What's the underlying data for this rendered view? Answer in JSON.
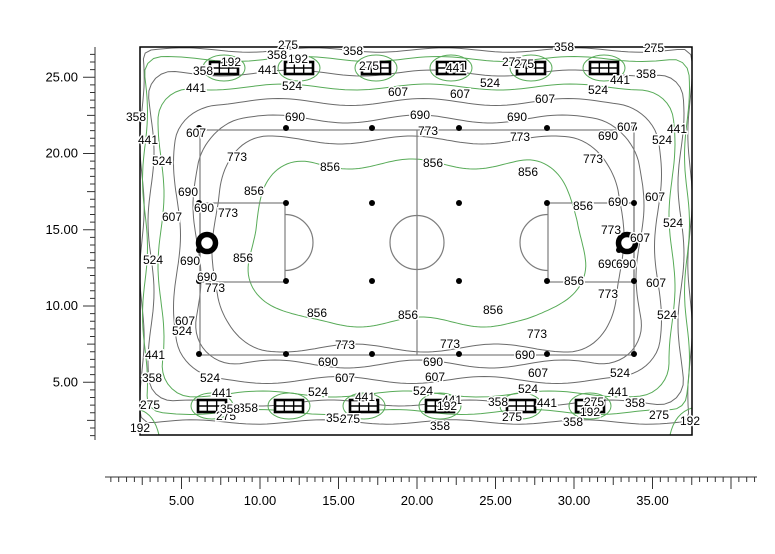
{
  "chart_data": {
    "type": "contour",
    "title": "Isolux contour plot of sports field illuminance (lux)",
    "legend_position": "none",
    "grid": false,
    "x_axis": {
      "tick_labels": [
        "5.00",
        "10.00",
        "15.00",
        "20.00",
        "25.00",
        "30.00",
        "35.00"
      ],
      "tick_values": [
        5,
        10,
        15,
        20,
        25,
        30,
        35
      ],
      "minor_step": 0.5,
      "medium_step": 2.5,
      "range": [
        0.5,
        41.5
      ],
      "px": {
        "origin": 103,
        "per_unit": 15.7,
        "line_y": 477,
        "line_x0": 105,
        "line_x1": 757
      }
    },
    "y_axis": {
      "tick_labels": [
        "5.00",
        "10.00",
        "15.00",
        "20.00",
        "25.00"
      ],
      "tick_values": [
        5,
        10,
        15,
        20,
        25
      ],
      "minor_step": 0.5,
      "medium_step": 2.5,
      "range": [
        1.5,
        26.5
      ],
      "px": {
        "origin": 458.5,
        "per_unit": 15.25,
        "line_x": 95,
        "line_y0": 47,
        "line_y1": 440
      }
    },
    "contour_levels": [
      192,
      275,
      358,
      441,
      524,
      607,
      690,
      773,
      856
    ],
    "green_levels": [
      192,
      358,
      524,
      856
    ],
    "colors": {
      "green": "#58ab58",
      "gray": "#6b6b6b",
      "field": "#7d7d7d",
      "border": "#000000"
    },
    "plot_rect": [
      140,
      47,
      692,
      435
    ],
    "contours": [
      {
        "level": 275,
        "rect": [
          142,
          50,
          690,
          422
        ],
        "rx": 9,
        "amp": 2.2,
        "k": 14
      },
      {
        "level": 358,
        "rect": [
          145,
          59,
          687,
          412
        ],
        "rx": 16,
        "amp": 2.5,
        "k": 13
      },
      {
        "level": 441,
        "rect": [
          151,
          73,
          681,
          403
        ],
        "rx": 24,
        "amp": 3,
        "k": 12
      },
      {
        "level": 524,
        "rect": [
          161,
          87,
          672,
          394
        ],
        "rx": 32,
        "amp": 3,
        "k": 11
      },
      {
        "level": 607,
        "rect": [
          177,
          102,
          658,
          380
        ],
        "rx": 40,
        "amp": 3.5,
        "k": 10
      },
      {
        "level": 690,
        "rect": [
          197,
          119,
          640,
          364
        ],
        "rx": 46,
        "amp": 4,
        "k": 9
      },
      {
        "level": 773,
        "rect": [
          216,
          140,
          620,
          348
        ],
        "rx": 52,
        "amp": 4,
        "k": 8
      },
      {
        "level": 856,
        "rect": [
          252,
          164,
          581,
          322
        ],
        "rx": 60,
        "amp": 5,
        "k": 7
      }
    ],
    "lamp_loop": {
      "level": 192,
      "rx": 21,
      "ry": 13
    },
    "corner_loops": [
      {
        "level": 192,
        "path": "M 140,410 Q 154,414 159,435"
      },
      {
        "level": 192,
        "path": "M 670,435 Q 675,413 692,408"
      }
    ],
    "field": {
      "rect": [
        200,
        130,
        634,
        355
      ],
      "half_line_x": 417,
      "center_circle": {
        "cx": 417,
        "cy": 242.5,
        "r": 27
      },
      "left_box": {
        "rect": [
          200,
          203,
          285,
          282
        ],
        "arc_cx": 285,
        "arc_r": 28
      },
      "right_box": {
        "rect": [
          548,
          203,
          634,
          282
        ],
        "arc_cx": 548,
        "arc_r": 28
      }
    },
    "grid_dots": {
      "cols": [
        199,
        286,
        372,
        459,
        547,
        634
      ],
      "rows": [
        128,
        203,
        281,
        354
      ],
      "r": 3
    },
    "poles": [
      {
        "x": 207,
        "y": 243
      },
      {
        "x": 627,
        "y": 243
      }
    ],
    "luminaires": {
      "w": 28,
      "h": 12,
      "top": {
        "y": 68,
        "x": [
          224,
          299,
          376,
          451,
          531,
          604
        ]
      },
      "bottom": {
        "y": 406,
        "x": [
          212,
          289,
          364,
          440,
          521,
          590
        ]
      }
    },
    "labels": [
      [
        358,
        203,
        71
      ],
      [
        192,
        231,
        62
      ],
      [
        275,
        288,
        45
      ],
      [
        358,
        277,
        55
      ],
      [
        192,
        298,
        59
      ],
      [
        441,
        268,
        70
      ],
      [
        441,
        196,
        88
      ],
      [
        524,
        292,
        86
      ],
      [
        358,
        353,
        51
      ],
      [
        275,
        369,
        66
      ],
      [
        607,
        398,
        92
      ],
      [
        607,
        460,
        94
      ],
      [
        524,
        490,
        83
      ],
      [
        275,
        512,
        62
      ],
      [
        441,
        456,
        68
      ],
      [
        358,
        564,
        47
      ],
      [
        275,
        524,
        64
      ],
      [
        524,
        598,
        90
      ],
      [
        441,
        620,
        80
      ],
      [
        358,
        646,
        74
      ],
      [
        275,
        654,
        48
      ],
      [
        607,
        545,
        99
      ],
      [
        690,
        295,
        117
      ],
      [
        690,
        420,
        115
      ],
      [
        690,
        517,
        117
      ],
      [
        773,
        428,
        131
      ],
      [
        773,
        520,
        137
      ],
      [
        856,
        433,
        163
      ],
      [
        856,
        528,
        172
      ],
      [
        773,
        237,
        157
      ],
      [
        856,
        254,
        191
      ],
      [
        856,
        330,
        167
      ],
      [
        607,
        196,
        133
      ],
      [
        690,
        608,
        136
      ],
      [
        607,
        627,
        127
      ],
      [
        441,
        677,
        129
      ],
      [
        524,
        662,
        140
      ],
      [
        773,
        593,
        159
      ],
      [
        358,
        136,
        117
      ],
      [
        441,
        148,
        140
      ],
      [
        524,
        162,
        161
      ],
      [
        690,
        188,
        192
      ],
      [
        690,
        204,
        208
      ],
      [
        607,
        172,
        217
      ],
      [
        524,
        153,
        260
      ],
      [
        690,
        190,
        261
      ],
      [
        690,
        207,
        277
      ],
      [
        773,
        215,
        288
      ],
      [
        856,
        243,
        258
      ],
      [
        607,
        185,
        321
      ],
      [
        524,
        182,
        331
      ],
      [
        773,
        228,
        213
      ],
      [
        441,
        155,
        355
      ],
      [
        358,
        152,
        378
      ],
      [
        275,
        150,
        405
      ],
      [
        192,
        140,
        428
      ],
      [
        524,
        210,
        378
      ],
      [
        441,
        222,
        393
      ],
      [
        275,
        226,
        416
      ],
      [
        358,
        248,
        408
      ],
      [
        607,
        655,
        197
      ],
      [
        690,
        618,
        202
      ],
      [
        856,
        583,
        206
      ],
      [
        773,
        611,
        230
      ],
      [
        607,
        640,
        238
      ],
      [
        524,
        673,
        223
      ],
      [
        690,
        608,
        264
      ],
      [
        690,
        626,
        264
      ],
      [
        856,
        574,
        281
      ],
      [
        607,
        656,
        283
      ],
      [
        773,
        608,
        294
      ],
      [
        524,
        667,
        315
      ],
      [
        856,
        317,
        313
      ],
      [
        856,
        408,
        315
      ],
      [
        856,
        493,
        310
      ],
      [
        773,
        345,
        345
      ],
      [
        773,
        450,
        344
      ],
      [
        773,
        537,
        334
      ],
      [
        690,
        328,
        362
      ],
      [
        690,
        433,
        362
      ],
      [
        690,
        525,
        355
      ],
      [
        607,
        345,
        378
      ],
      [
        607,
        435,
        377
      ],
      [
        607,
        538,
        373
      ],
      [
        524,
        318,
        392
      ],
      [
        524,
        423,
        391
      ],
      [
        524,
        528,
        389
      ],
      [
        524,
        620,
        373
      ],
      [
        441,
        365,
        397
      ],
      [
        441,
        452,
        400
      ],
      [
        441,
        547,
        403
      ],
      [
        441,
        618,
        392
      ],
      [
        358,
        336,
        418
      ],
      [
        275,
        350,
        419
      ],
      [
        192,
        447,
        406
      ],
      [
        358,
        440,
        426
      ],
      [
        358,
        498,
        402
      ],
      [
        275,
        512,
        417
      ],
      [
        192,
        590,
        412
      ],
      [
        275,
        594,
        402
      ],
      [
        358,
        573,
        422
      ],
      [
        358,
        635,
        403
      ],
      [
        275,
        659,
        415
      ],
      [
        192,
        690,
        421
      ],
      [
        358,
        230,
        409
      ]
    ]
  }
}
